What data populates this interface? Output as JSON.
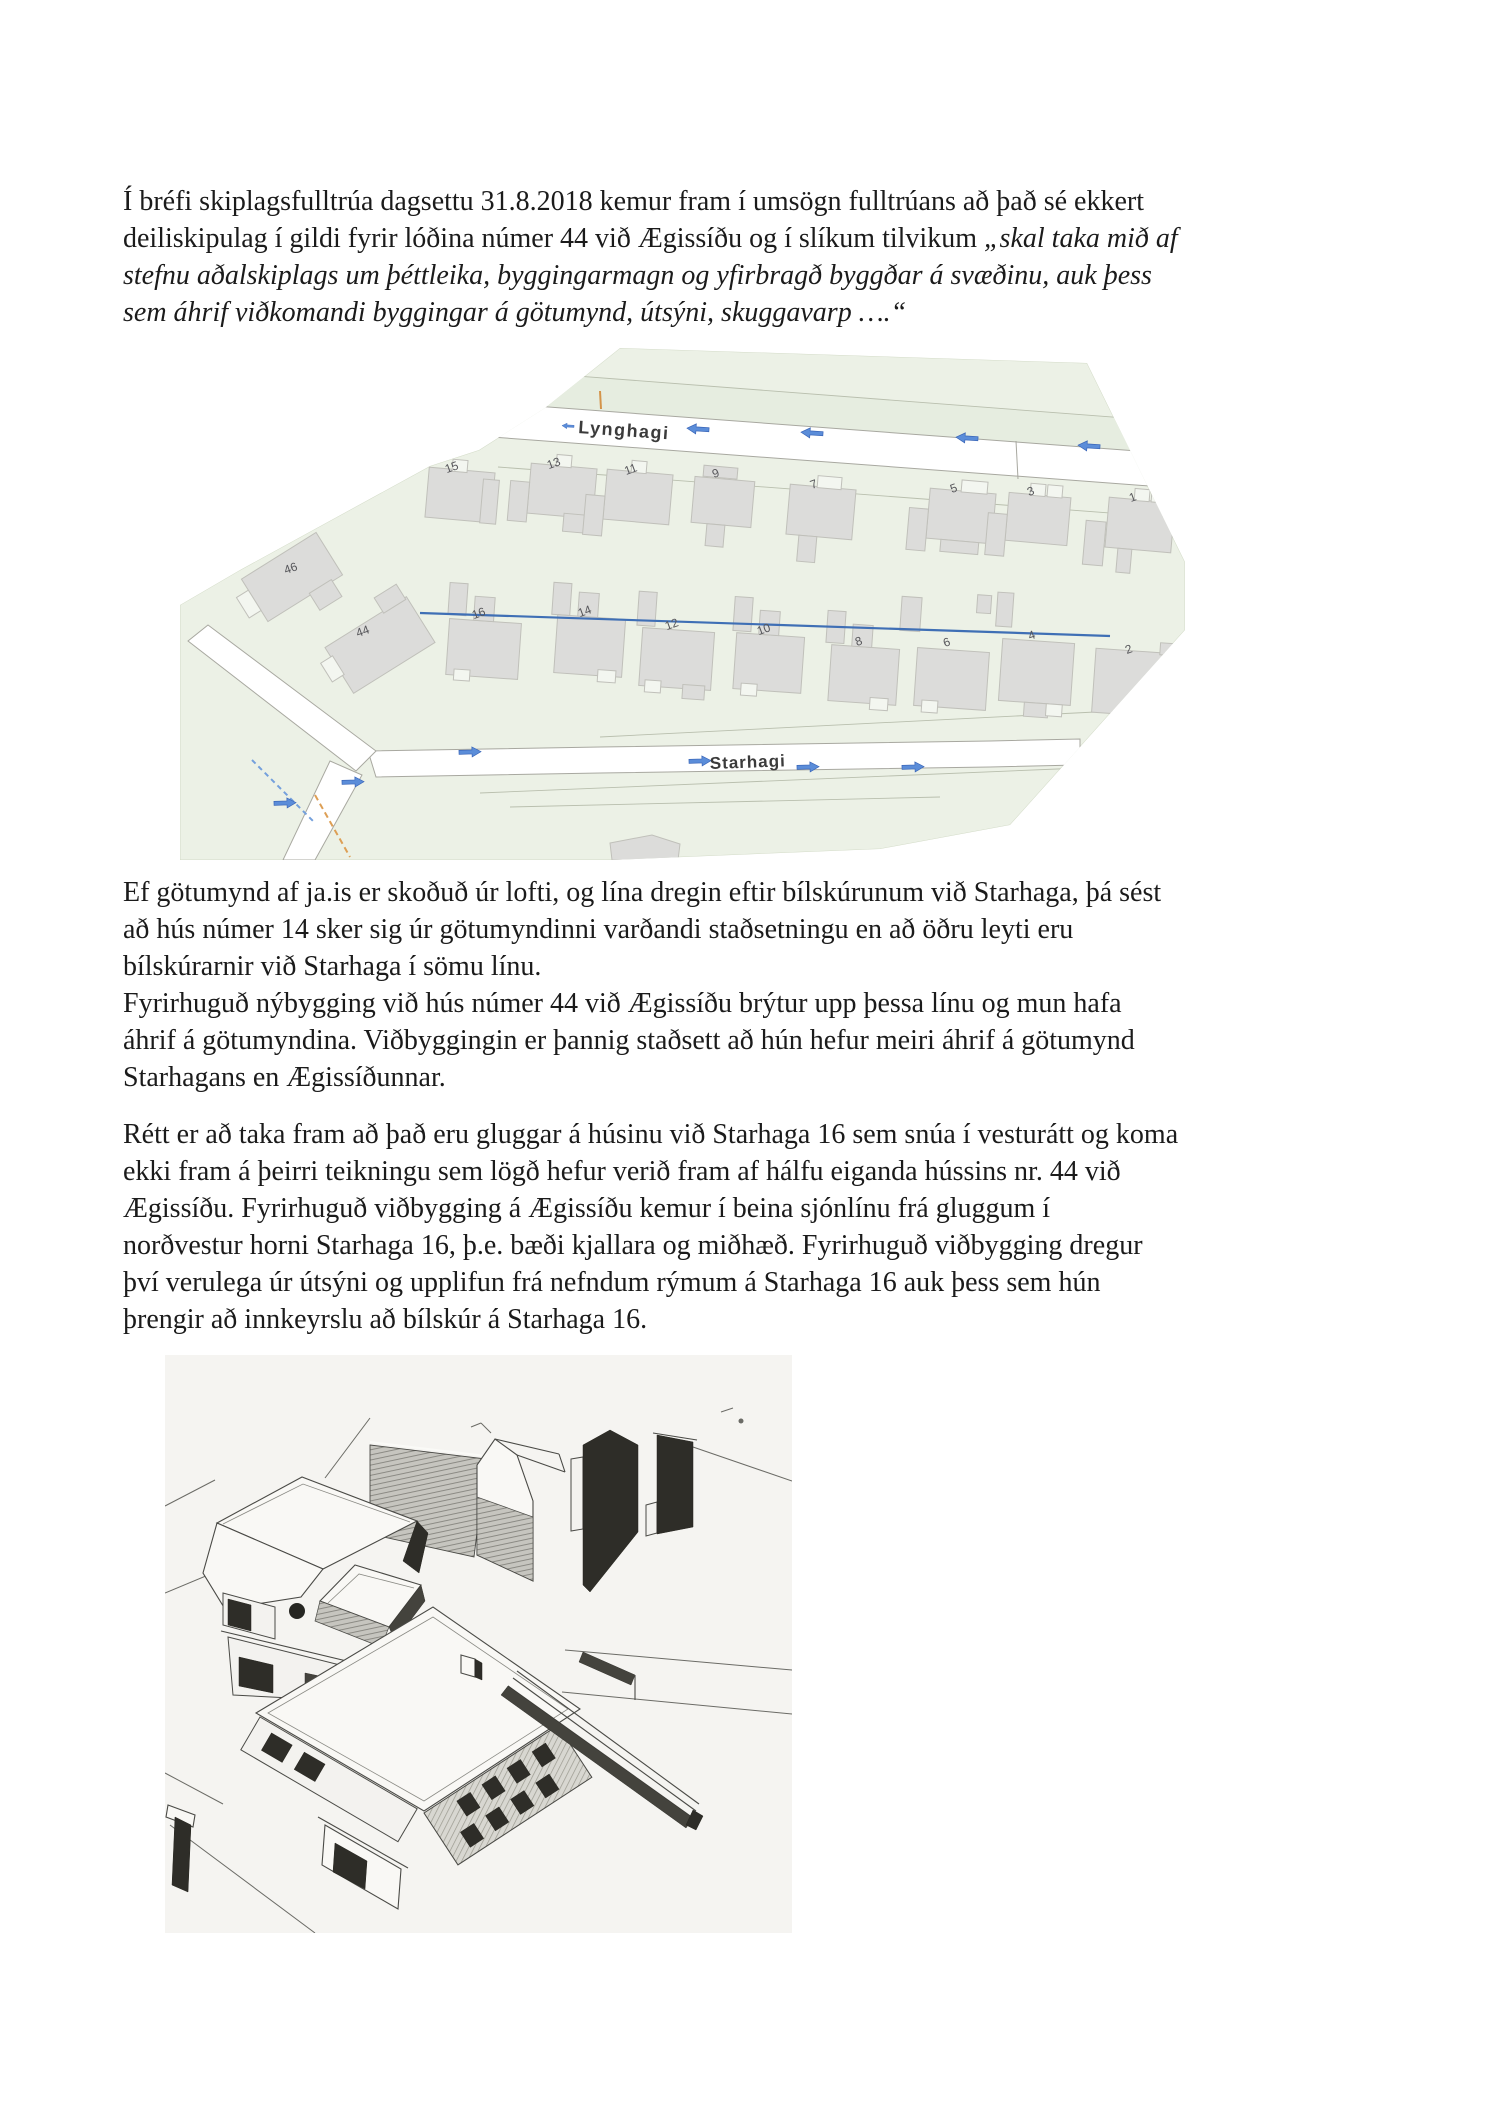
{
  "document": {
    "paragraph1": {
      "line1": "Í bréfi skiplagsfulltrúa dagsettu 31.8.2018 kemur fram í umsögn fulltrúans að það sé ekkert",
      "line2_regular": "deiliskipulag í gildi fyrir lóðina númer 44 við Ægissíðu og í slíkum tilvikum ",
      "line2_italic": "„skal taka mið af",
      "line3_italic": "stefnu aðalskiplags um þéttleika, byggingarmagn og yfirbragð byggðar á svæðinu, auk þess",
      "line4_italic": "sem áhrif viðkomandi byggingar á götumynd, útsýni, skuggavarp ….“"
    },
    "paragraph2": {
      "line1": "Ef götumynd af ja.is er skoðuð úr lofti, og lína dregin eftir bílskúrunum við Starhaga, þá sést",
      "line2": "að hús númer 14 sker sig úr götumyndinni varðandi staðsetningu en að öðru leyti eru",
      "line3": "bílskúrarnir við Starhaga í sömu línu.",
      "line4": "Fyrirhuguð nýbygging við hús númer 44 við Ægissíðu brýtur upp þessa línu og mun hafa",
      "line5": "áhrif á götumyndina. Viðbyggingin er þannig staðsett að hún hefur meiri áhrif á götumynd",
      "line6": "Starhagans en Ægissíðunnar."
    },
    "paragraph3": {
      "line1": "Rétt er að taka fram að það eru gluggar á húsinu við Starhaga 16 sem snúa í vesturátt og koma",
      "line2": "ekki fram á þeirri teikningu sem lögð hefur verið fram af hálfu eiganda hússins nr. 44 við",
      "line3": "Ægissíðu. Fyrirhuguð viðbygging á Ægissíðu kemur í beina sjónlínu frá  gluggum í",
      "line4": "norðvestur horni Starhaga 16, þ.e. bæði kjallara og miðhæð.  Fyrirhuguð viðbygging dregur",
      "line5": "því verulega úr útsýni og upplifun frá nefndum rýmum á Starhaga 16 auk þess sem hún",
      "line6": "þrengir að innkeyrslu að bílskúr á Starhaga 16."
    }
  },
  "map": {
    "street_top": "Lynghagi",
    "street_bottom": "Starhagi",
    "top_row_numbers": [
      "15",
      "13",
      "11",
      "9",
      "7",
      "5",
      "3",
      "1"
    ],
    "bottom_row_numbers": [
      "16",
      "14",
      "12",
      "10",
      "8",
      "6",
      "4",
      "2"
    ],
    "corner_numbers": [
      "46",
      "44"
    ],
    "colors": {
      "area_green": "#ecf1e6",
      "building_gray": "#dcdcda",
      "arrow_blue": "#5b8dd9",
      "sight_line_blue": "#3f6fb5",
      "road_white": "#ffffff"
    }
  },
  "drawing": {
    "colors": {
      "background": "#f5f4f1",
      "line": "#4a4a46",
      "dark_face": "#2e2d28"
    }
  }
}
